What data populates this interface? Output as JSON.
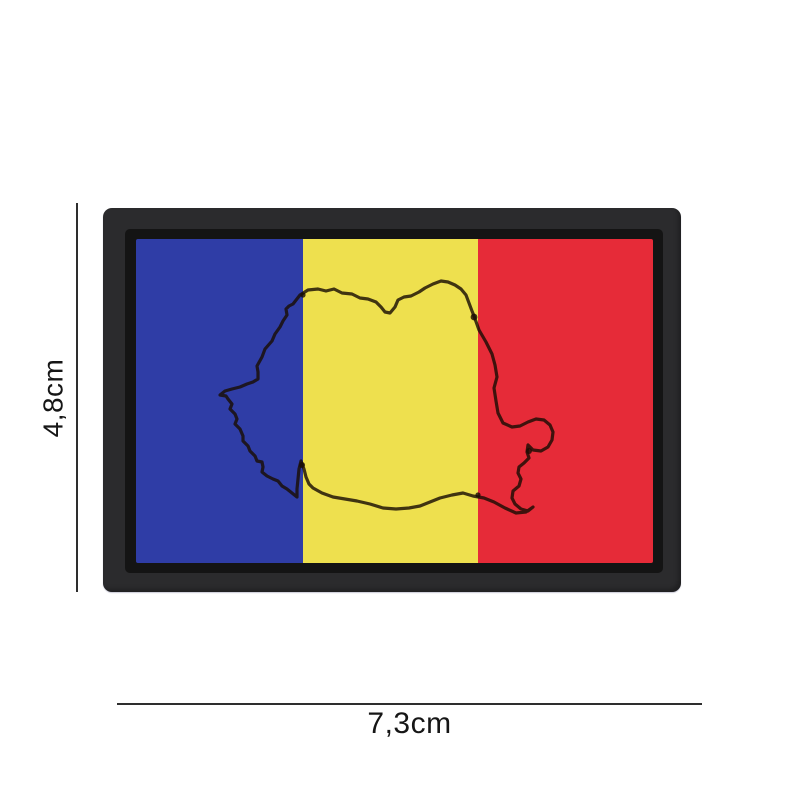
{
  "patch": {
    "name": "romania-flag-pvc-patch",
    "border_color": "#2b2b2d",
    "frame_color": "#141414",
    "stripe_colors": {
      "blue": "#2f3da6",
      "yellow": "#eee04e",
      "red": "#e62b38"
    },
    "outline_color": "rgba(26,13,4,0.82)"
  },
  "annotations": {
    "height_label": "4,8cm",
    "width_label": "7,3cm",
    "line_color": "#2e2e2e"
  }
}
